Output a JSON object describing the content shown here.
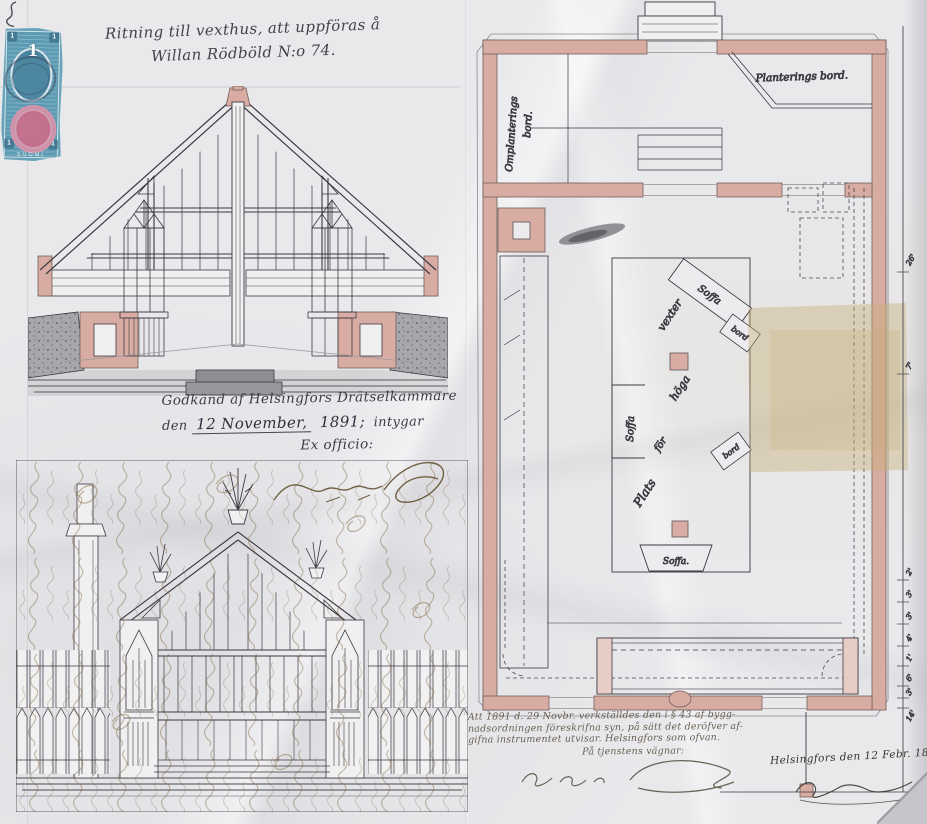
{
  "title": {
    "line1": "Ritning till vexthus, att uppföras å",
    "line2": "Willan Rödböld N:o 74."
  },
  "stamp": {
    "center_value": "1",
    "corner_value": "1",
    "country": "SUOMI"
  },
  "approval": {
    "line1": "Godkänd af Helsingfors Drätselkammare",
    "den": "den",
    "date": "12 November,",
    "year": "1891;",
    "intygar": "intygar",
    "ex_officio": "Ex officio:"
  },
  "plan": {
    "left_table_1": "Omplanterings",
    "left_table_2": "bord.",
    "top_right_table": "Planterings bord.",
    "center_words": [
      "Plats",
      "för",
      "höga",
      "vexter"
    ],
    "sofa_left": "Soffa",
    "sofa_top": "Soffa",
    "sofa_bottom": "Soffa.",
    "bord_upper": "bord",
    "bord_lower": "bord",
    "dimensions": [
      "26'",
      "7'",
      "2'",
      "3'",
      "3'",
      "4'",
      "1'",
      "6'",
      "3'",
      "14'"
    ]
  },
  "note": {
    "line1": "Att 1891 d. 29 Novbr. verkställdes den i § 43 af bygg-",
    "line2": "nadsordningen föreskrifna syn, på sätt det deröfver af-",
    "line3": "gifna instrumentet utvisar. Helsingfors som ofvan.",
    "line4": "På tjenstens vägnar:"
  },
  "dateline": {
    "text": "Helsingfors den 12 Febr. 1891."
  }
}
